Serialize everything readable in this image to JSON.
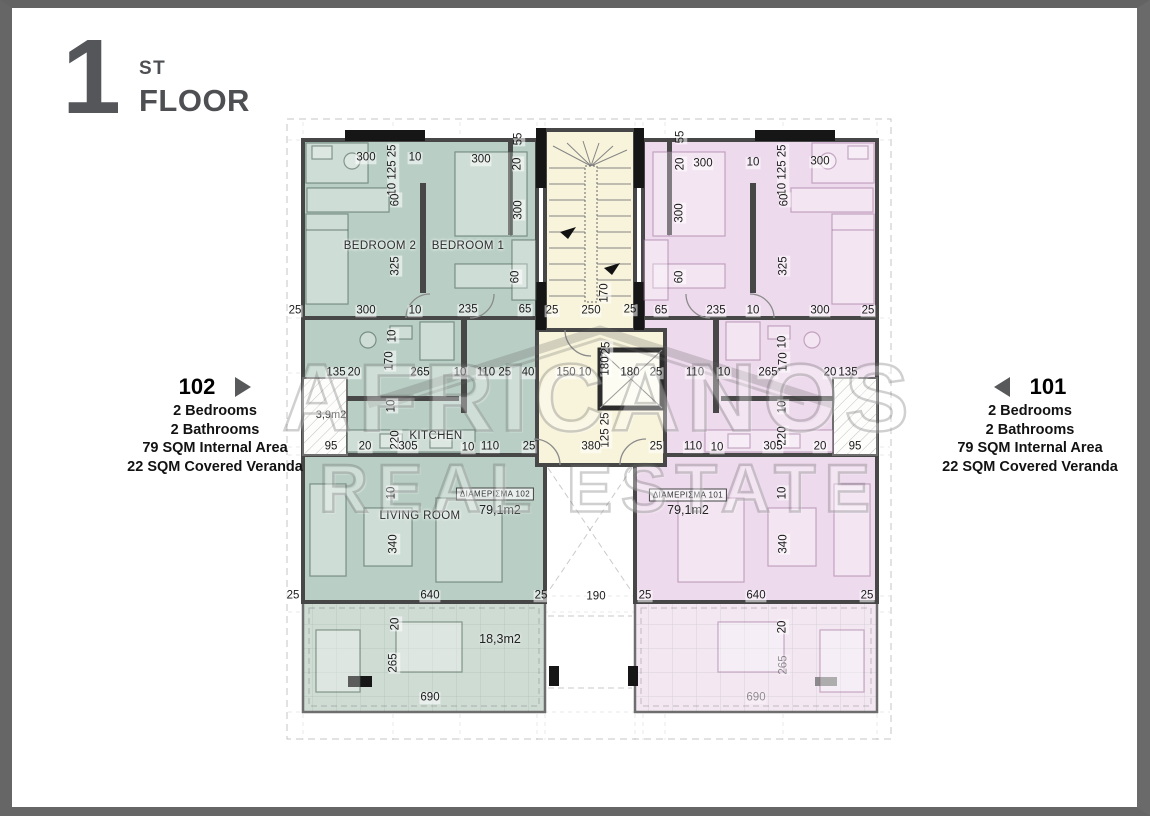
{
  "title": {
    "number": "1",
    "suffix": "ST",
    "word": "FLOOR"
  },
  "apartments": {
    "left": {
      "id": "102",
      "lines": [
        "2 Bedrooms",
        "2 Bathrooms",
        "79 SQM Internal Area",
        "22 SQM Covered Veranda"
      ]
    },
    "right": {
      "id": "101",
      "lines": [
        "2 Bedrooms",
        "2 Bathrooms",
        "79 SQM Internal Area",
        "22 SQM Covered Veranda"
      ]
    }
  },
  "watermark": {
    "line1": "AFRICANOS",
    "line2": "REAL ESTATE"
  },
  "colors": {
    "apartment_102_fill": "#b9cfc5",
    "apartment_101_fill": "#eedaed",
    "stair_core_fill": "#f8f4dc",
    "wall": "#474747",
    "title_gray": "#55565a",
    "frame_gray": "#666666"
  },
  "plan": {
    "labels": [
      {
        "t": "BEDROOM 2",
        "x": 380,
        "y": 246,
        "cls": "room"
      },
      {
        "t": "BEDROOM 1",
        "x": 468,
        "y": 246,
        "cls": "room"
      },
      {
        "t": "KITCHEN",
        "x": 436,
        "y": 436,
        "cls": "room"
      },
      {
        "t": "LIVING ROOM",
        "x": 420,
        "y": 516,
        "cls": "room"
      },
      {
        "t": "3,9m2",
        "x": 331,
        "y": 415,
        "cls": "area-sm"
      },
      {
        "t": "18,3m2",
        "x": 500,
        "y": 639,
        "cls": "area"
      },
      {
        "t": "79,1m2",
        "x": 500,
        "y": 510,
        "cls": "area"
      },
      {
        "t": "79,1m2",
        "x": 688,
        "y": 510,
        "cls": "area"
      },
      {
        "t": "ΔΙΑΜΕΡΙΣΜΑ 102",
        "x": 495,
        "y": 494,
        "cls": "badge"
      },
      {
        "t": "ΔΙΑΜΕΡΙΣΜΑ 101",
        "x": 688,
        "y": 495,
        "cls": "badge"
      }
    ],
    "dimensions": [
      {
        "t": "300",
        "x": 366,
        "y": 158
      },
      {
        "t": "10",
        "x": 415,
        "y": 158
      },
      {
        "t": "300",
        "x": 481,
        "y": 160
      },
      {
        "t": "10 125 25",
        "x": 393,
        "y": 170,
        "r": 1
      },
      {
        "t": "20",
        "x": 518,
        "y": 164,
        "r": 1
      },
      {
        "t": "55",
        "x": 519,
        "y": 139,
        "r": 1
      },
      {
        "t": "300",
        "x": 703,
        "y": 164
      },
      {
        "t": "10",
        "x": 753,
        "y": 163
      },
      {
        "t": "300",
        "x": 820,
        "y": 162
      },
      {
        "t": "10 125 25",
        "x": 783,
        "y": 170,
        "r": 1
      },
      {
        "t": "20",
        "x": 681,
        "y": 164,
        "r": 1
      },
      {
        "t": "55",
        "x": 681,
        "y": 137,
        "r": 1
      },
      {
        "t": "60",
        "x": 396,
        "y": 200,
        "r": 1
      },
      {
        "t": "300",
        "x": 519,
        "y": 210,
        "r": 1
      },
      {
        "t": "60",
        "x": 785,
        "y": 200,
        "r": 1
      },
      {
        "t": "300",
        "x": 680,
        "y": 213,
        "r": 1
      },
      {
        "t": "325",
        "x": 396,
        "y": 266,
        "r": 1
      },
      {
        "t": "325",
        "x": 784,
        "y": 266,
        "r": 1
      },
      {
        "t": "60",
        "x": 516,
        "y": 277,
        "r": 1
      },
      {
        "t": "60",
        "x": 680,
        "y": 277,
        "r": 1
      },
      {
        "t": "25",
        "x": 295,
        "y": 311
      },
      {
        "t": "300",
        "x": 366,
        "y": 311
      },
      {
        "t": "10",
        "x": 415,
        "y": 311
      },
      {
        "t": "235",
        "x": 468,
        "y": 310
      },
      {
        "t": "65",
        "x": 525,
        "y": 310
      },
      {
        "t": "25",
        "x": 552,
        "y": 311
      },
      {
        "t": "250",
        "x": 591,
        "y": 311
      },
      {
        "t": "25",
        "x": 630,
        "y": 310
      },
      {
        "t": "65",
        "x": 661,
        "y": 311
      },
      {
        "t": "235",
        "x": 716,
        "y": 311
      },
      {
        "t": "10",
        "x": 753,
        "y": 311
      },
      {
        "t": "300",
        "x": 820,
        "y": 311
      },
      {
        "t": "25",
        "x": 868,
        "y": 311
      },
      {
        "t": "170",
        "x": 605,
        "y": 293,
        "r": 1
      },
      {
        "t": "10",
        "x": 393,
        "y": 336,
        "r": 1
      },
      {
        "t": "170",
        "x": 390,
        "y": 361,
        "r": 1
      },
      {
        "t": "10",
        "x": 783,
        "y": 342,
        "r": 1
      },
      {
        "t": "170",
        "x": 784,
        "y": 362,
        "r": 1
      },
      {
        "t": "25",
        "x": 607,
        "y": 348,
        "r": 1
      },
      {
        "t": "180",
        "x": 606,
        "y": 366,
        "r": 1
      },
      {
        "t": "125 25",
        "x": 606,
        "y": 430,
        "r": 1
      },
      {
        "t": "10",
        "x": 392,
        "y": 406,
        "r": 1
      },
      {
        "t": "220",
        "x": 396,
        "y": 440,
        "r": 1
      },
      {
        "t": "10",
        "x": 783,
        "y": 407,
        "r": 1
      },
      {
        "t": "220",
        "x": 783,
        "y": 436,
        "r": 1
      },
      {
        "t": "10",
        "x": 392,
        "y": 493,
        "r": 1
      },
      {
        "t": "10",
        "x": 783,
        "y": 493,
        "r": 1
      },
      {
        "t": "135",
        "x": 336,
        "y": 373
      },
      {
        "t": "20",
        "x": 354,
        "y": 373
      },
      {
        "t": "265",
        "x": 420,
        "y": 373
      },
      {
        "t": "10",
        "x": 460,
        "y": 373
      },
      {
        "t": "110 25",
        "x": 494,
        "y": 373
      },
      {
        "t": "40",
        "x": 528,
        "y": 373
      },
      {
        "t": "150",
        "x": 566,
        "y": 373
      },
      {
        "t": "10",
        "x": 585,
        "y": 373
      },
      {
        "t": "180",
        "x": 630,
        "y": 373
      },
      {
        "t": "25",
        "x": 656,
        "y": 373
      },
      {
        "t": "110",
        "x": 695,
        "y": 373
      },
      {
        "t": "10",
        "x": 724,
        "y": 373
      },
      {
        "t": "265",
        "x": 768,
        "y": 373
      },
      {
        "t": "20",
        "x": 830,
        "y": 373
      },
      {
        "t": "135",
        "x": 848,
        "y": 373
      },
      {
        "t": "95",
        "x": 331,
        "y": 447
      },
      {
        "t": "20",
        "x": 365,
        "y": 447
      },
      {
        "t": "305",
        "x": 408,
        "y": 447
      },
      {
        "t": "10",
        "x": 468,
        "y": 448
      },
      {
        "t": "110",
        "x": 490,
        "y": 447
      },
      {
        "t": "25",
        "x": 529,
        "y": 447
      },
      {
        "t": "380",
        "x": 591,
        "y": 447
      },
      {
        "t": "25",
        "x": 656,
        "y": 447
      },
      {
        "t": "110",
        "x": 693,
        "y": 447
      },
      {
        "t": "10",
        "x": 717,
        "y": 448
      },
      {
        "t": "305",
        "x": 773,
        "y": 447
      },
      {
        "t": "20",
        "x": 820,
        "y": 447
      },
      {
        "t": "95",
        "x": 855,
        "y": 447
      },
      {
        "t": "340",
        "x": 394,
        "y": 544,
        "r": 1
      },
      {
        "t": "340",
        "x": 784,
        "y": 544,
        "r": 1
      },
      {
        "t": "25",
        "x": 293,
        "y": 596
      },
      {
        "t": "640",
        "x": 430,
        "y": 596
      },
      {
        "t": "25",
        "x": 541,
        "y": 596
      },
      {
        "t": "190",
        "x": 596,
        "y": 597
      },
      {
        "t": "25",
        "x": 645,
        "y": 596
      },
      {
        "t": "640",
        "x": 756,
        "y": 596
      },
      {
        "t": "25",
        "x": 867,
        "y": 596
      },
      {
        "t": "20",
        "x": 396,
        "y": 624,
        "r": 1
      },
      {
        "t": "20",
        "x": 783,
        "y": 627,
        "r": 1
      },
      {
        "t": "265",
        "x": 394,
        "y": 663,
        "r": 1
      },
      {
        "t": "265",
        "x": 784,
        "y": 665,
        "r": 1,
        "f": 1
      },
      {
        "t": "690",
        "x": 430,
        "y": 698
      },
      {
        "t": "690",
        "x": 756,
        "y": 698,
        "f": 1
      }
    ]
  }
}
